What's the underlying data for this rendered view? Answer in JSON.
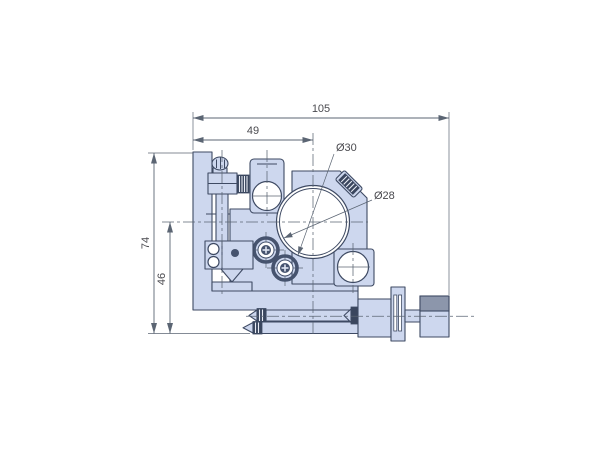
{
  "drawing": {
    "kind": "technical-drawing",
    "subject": "kinematic optic mount, front elevation with micrometer actuator",
    "colors": {
      "part_fill": "#cdd7ee",
      "part_outline": "#3e4a63",
      "annotation_line": "#5b6573",
      "label_text": "#4a4a4f",
      "knurl_dark": "#3a465e",
      "knob_shade": "#8c96ab",
      "background": "#ffffff"
    },
    "dimensions": {
      "total_width": "105",
      "left_face_to_axis": "49",
      "total_height": "74",
      "axis_to_bottom": "46",
      "bore_outer_diameter": "Ø30",
      "clear_aperture_diameter": "Ø28"
    }
  }
}
